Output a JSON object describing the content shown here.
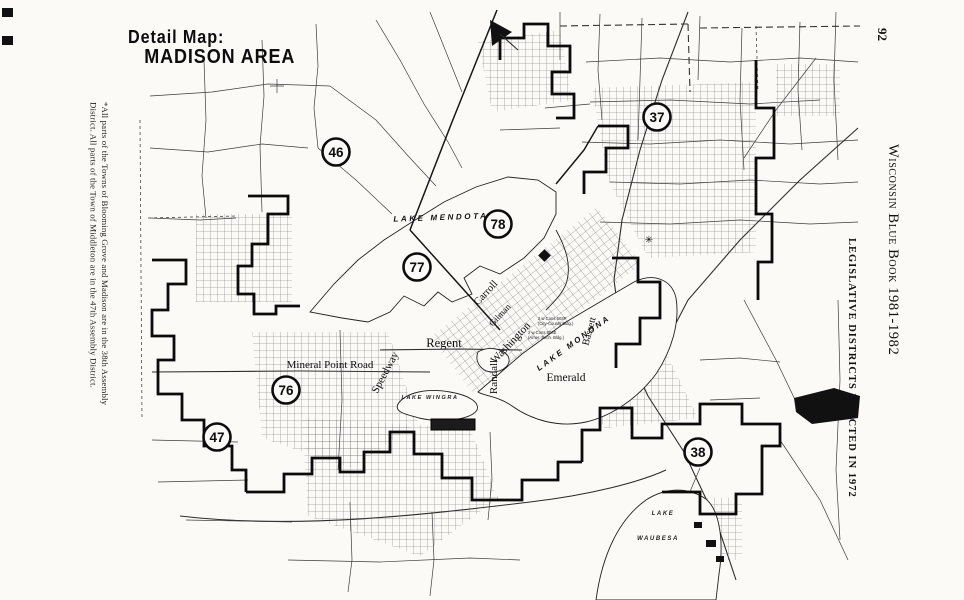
{
  "page": {
    "number": "92",
    "book_title": "Wisconsin Blue Book 1981-1982",
    "section_heading": "LEGISLATIVE DISTRICTS ENACTED IN 1972",
    "footnote_line1": "*All parts of the Towns of Blooming Grove and Madison are in the 38th Assembly",
    "footnote_line2": "District. All parts of the Town of Middleton are in the 47th Assembly District."
  },
  "map": {
    "title_line1": "Detail Map:",
    "title_line2": "MADISON AREA",
    "districts": [
      {
        "number": "46"
      },
      {
        "number": "37"
      },
      {
        "number": "78"
      },
      {
        "number": "77"
      },
      {
        "number": "76"
      },
      {
        "number": "47"
      },
      {
        "number": "38"
      }
    ],
    "lakes": {
      "mendota": "LAKE MENDOTA",
      "monona": "LAKE MONONA",
      "wingra": "LAKE WINGRA",
      "waubesa_line1": "LAKE",
      "waubesa_line2": "WAUBESA"
    },
    "streets": {
      "mineral_point": "Mineral Point Road",
      "regent": "Regent",
      "emerald": "Emerald",
      "speedway": "Speedway",
      "randall": "Randall",
      "bassett": "Bassett",
      "washington": "Washington",
      "gilman": "Gilman",
      "carroll": "Carroll"
    },
    "small_annotations": {
      "cons1": "2 w Cons 503P",
      "cons1b": "(City-County Bldg.)",
      "cons2": "2 w Cons 503E",
      "cons2b": "(Amer. Exch. Bldg.)"
    },
    "symbols": {
      "capitol_asterisk": "✳"
    }
  },
  "colors": {
    "ink": "#111111",
    "paper": "#fbfaf7"
  }
}
